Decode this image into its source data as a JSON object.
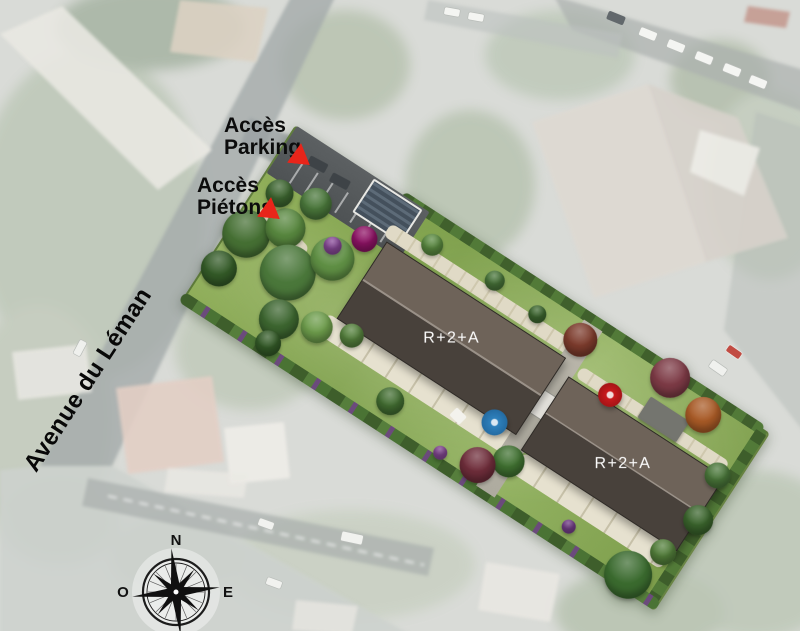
{
  "annotations": {
    "parking_access": {
      "line1": "Accès",
      "line2": "Parking"
    },
    "pedestrian_access": {
      "line1": "Accès",
      "line2": "Piétons"
    }
  },
  "street_name": "Avenue du Léman",
  "buildings": [
    {
      "label": "R+2+A"
    },
    {
      "label": "R+2+A"
    }
  ],
  "compass": {
    "north": "N",
    "west": "O",
    "east": "E"
  },
  "colors": {
    "marker_red": "#e8251a",
    "roof_light": "#6e6359",
    "roof_dark": "#48413b",
    "lawn_green": "#84a452",
    "hedge_green": "#47672f",
    "path_beige": "#ddd7c1",
    "parking_gray": "#55585a",
    "umbrella_blue": "#2b7ab8",
    "umbrella_red": "#c8191d",
    "tree_magenta": "#8e1365"
  }
}
